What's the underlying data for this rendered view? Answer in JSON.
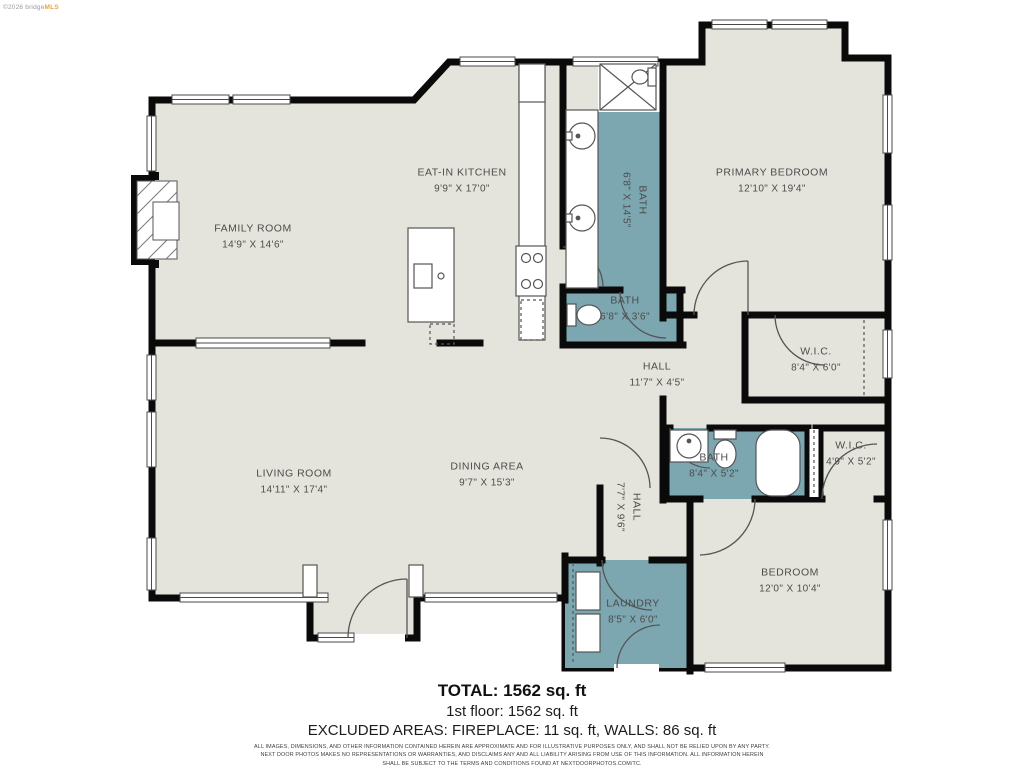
{
  "watermark": {
    "prefix": "©2026 bridge",
    "suffix": "MLS"
  },
  "colors": {
    "floor": "#e5e4dc",
    "wet": "#7ca6b0",
    "wall": "#0a0a0a",
    "label": "#4c4c4c",
    "brand_accent": "#e8a33d"
  },
  "rooms": [
    {
      "id": "family-room",
      "name": "FAMILY ROOM",
      "dims": "14'9\" X 14'6\""
    },
    {
      "id": "eat-in-kitchen",
      "name": "EAT-IN KITCHEN",
      "dims": "9'9\" X 17'0\""
    },
    {
      "id": "bath-long",
      "name": "BATH",
      "dims": "6'8\" X 14'5\""
    },
    {
      "id": "primary-bedroom",
      "name": "PRIMARY BEDROOM",
      "dims": "12'10\" X 19'4\""
    },
    {
      "id": "bath-small",
      "name": "BATH",
      "dims": "6'8\" X 3'6\""
    },
    {
      "id": "hall-upper",
      "name": "HALL",
      "dims": "11'7\" X 4'5\""
    },
    {
      "id": "wic-upper",
      "name": "W.I.C.",
      "dims": "8'4\" X 6'0\""
    },
    {
      "id": "bath-mid",
      "name": "BATH",
      "dims": "8'4\" X 5'2\""
    },
    {
      "id": "wic-lower",
      "name": "W.I.C.",
      "dims": "4'9\" X 5'2\""
    },
    {
      "id": "living-room",
      "name": "LIVING ROOM",
      "dims": "14'11\" X 17'4\""
    },
    {
      "id": "dining-area",
      "name": "DINING AREA",
      "dims": "9'7\" X 15'3\""
    },
    {
      "id": "hall-lower",
      "name": "HALL",
      "dims": "7'7\" X 9'6\""
    },
    {
      "id": "laundry",
      "name": "LAUNDRY",
      "dims": "8'5\" X 6'0\""
    },
    {
      "id": "bedroom",
      "name": "BEDROOM",
      "dims": "12'0\" X 10'4\""
    }
  ],
  "footer": {
    "total": "TOTAL: 1562 sq. ft",
    "floor1": "1st floor: 1562 sq. ft",
    "excluded": "EXCLUDED AREAS: FIREPLACE: 11 sq. ft, WALLS: 86 sq. ft",
    "disclaimer_line1": "ALL IMAGES, DIMENSIONS, AND OTHER INFORMATION CONTAINED HEREIN ARE APPROXIMATE AND FOR ILLUSTRATIVE PURPOSES ONLY, AND SHALL NOT BE RELIED UPON BY ANY PARTY.",
    "disclaimer_line2": "NEXT DOOR PHOTOS MAKES NO REPRESENTATIONS OR WARRANTIES, AND DISCLAIMS ANY AND ALL LIABILITY ARISING FROM USE OF THIS INFORMATION. ALL INFORMATION HEREIN",
    "disclaimer_line3": "SHALL BE SUBJECT TO THE TERMS AND CONDITIONS FOUND AT NEXTDOORPHOTOS.COM/TC."
  }
}
